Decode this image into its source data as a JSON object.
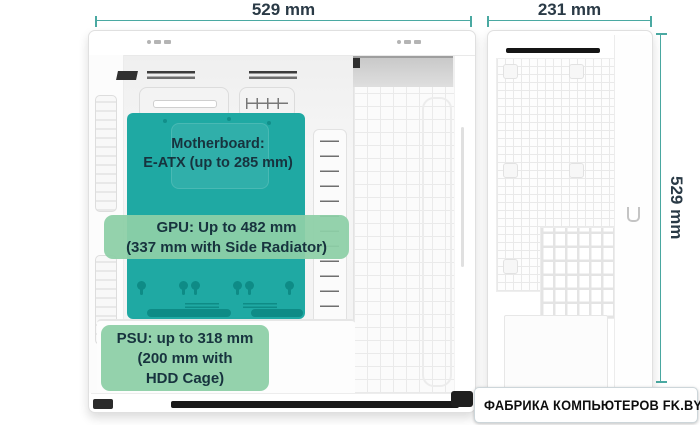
{
  "dims": {
    "width_label": "529 mm",
    "depth_label": "231 mm",
    "height_label": "529 mm"
  },
  "labels": {
    "motherboard": {
      "line1": "Motherboard:",
      "line2": "E-ATX (up to 285 mm)"
    },
    "gpu": {
      "line1": "GPU: Up to 482 mm",
      "line2": "(337 mm with Side Radiator)"
    },
    "psu": {
      "line1": "PSU: up to 318 mm",
      "line2": "(200 mm with",
      "line3": "HDD Cage)"
    }
  },
  "logo": {
    "text": "ФАБРИКА КОМПЬЮТЕРОВ FK.BY"
  },
  "icons": {
    "logo_mark": "diamond-checkmark"
  },
  "colors": {
    "tray_teal": "#1FA9A3",
    "tray_teal_dark": "#0E8B86",
    "label_green": "#8DCFA7",
    "dimension_line": "#4AA9A2",
    "text_dark": "#17333E",
    "logo_check_blue": "#1E9CD7"
  }
}
